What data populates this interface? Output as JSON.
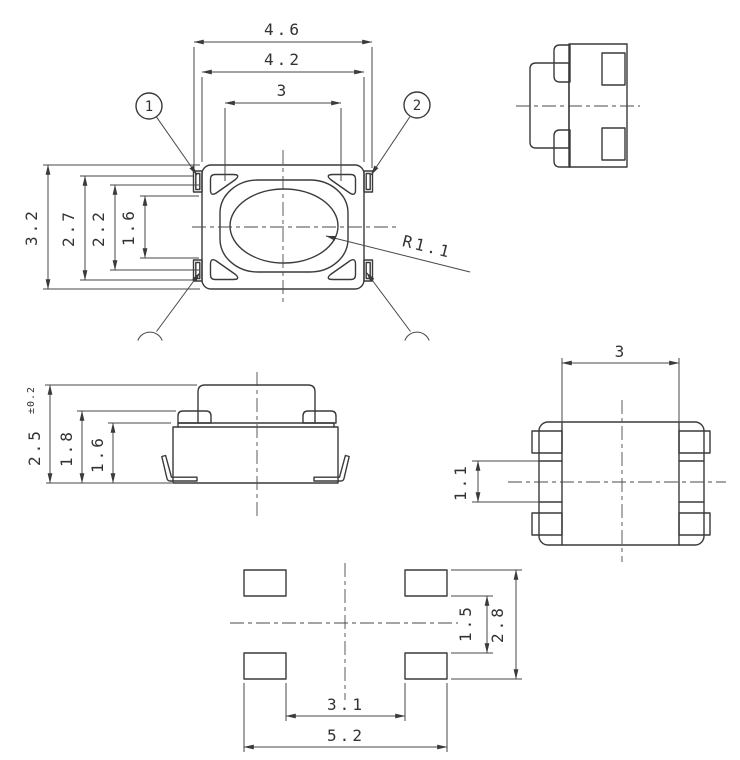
{
  "drawing": {
    "type": "technical-drawing-tactile-switch",
    "colors": {
      "line": "#3a3a3a",
      "dimension_line": "#474747",
      "background": "#ffffff"
    },
    "views": {
      "top": {
        "balloon_1": "1",
        "balloon_2": "2",
        "dim_width_outer": "4.6",
        "dim_width_body": "4.2",
        "dim_width_button": "3",
        "dim_height_body": "3.2",
        "dim_height_terminals": "2.7",
        "dim_height_button": "2.2",
        "dim_height_inner": "1.6",
        "radius_callout": "R1.1"
      },
      "side": {
        "name": "side-view"
      },
      "front": {
        "dim_total_height": "2.5",
        "dim_total_height_tol": "±0.2",
        "dim_terminal_height": "1.8",
        "dim_body_height": "1.6"
      },
      "bottom": {
        "dim_terminal_span": "3",
        "dim_terminal_gap": "1.1"
      },
      "land_pattern": {
        "dim_pad_gap_vertical": "1.5",
        "dim_pad_span_vertical": "2.8",
        "dim_pad_gap_horizontal": "3.1",
        "dim_pad_span_horizontal": "5.2"
      }
    }
  }
}
